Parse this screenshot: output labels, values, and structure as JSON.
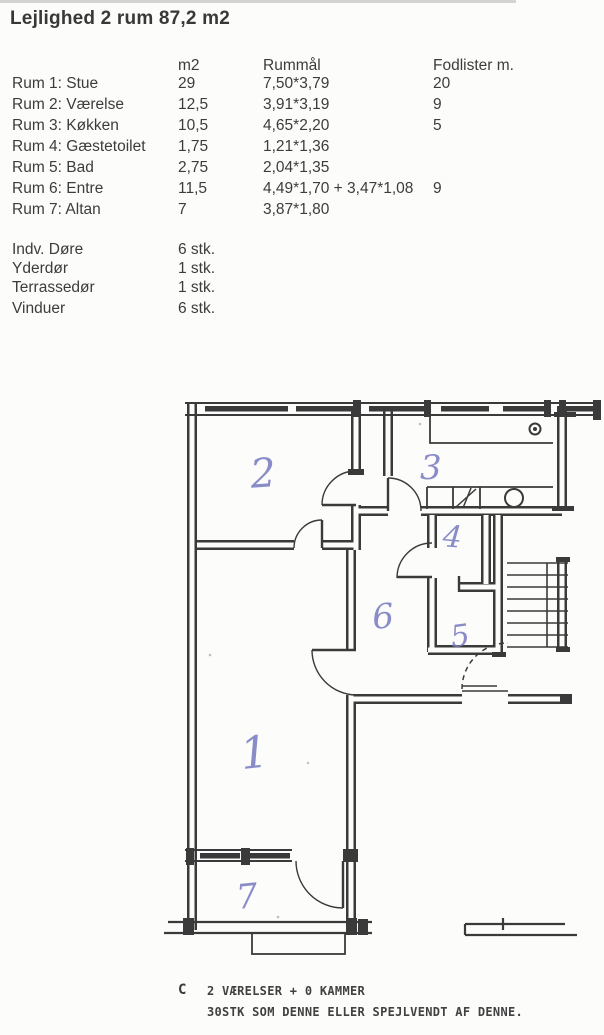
{
  "title": "Lejlighed 2 rum 87,2 m2",
  "room_table": {
    "headers": {
      "m2": "m2",
      "rummaal": "Rummål",
      "fodlister": "Fodlister m."
    },
    "rows": [
      {
        "label": "Rum 1: Stue",
        "m2": "29",
        "rummaal": "7,50*3,79",
        "fodlister": "20"
      },
      {
        "label": "Rum 2: Værelse",
        "m2": "12,5",
        "rummaal": "3,91*3,19",
        "fodlister": "9"
      },
      {
        "label": "Rum 3: Køkken",
        "m2": "10,5",
        "rummaal": "4,65*2,20",
        "fodlister": "5"
      },
      {
        "label": "Rum 4: Gæstetoilet",
        "m2": "1,75",
        "rummaal": "1,21*1,36",
        "fodlister": ""
      },
      {
        "label": "Rum 5: Bad",
        "m2": "2,75",
        "rummaal": "2,04*1,35",
        "fodlister": ""
      },
      {
        "label": "Rum 6: Entre",
        "m2": "11,5",
        "rummaal": "4,49*1,70 + 3,47*1,08",
        "fodlister": "9"
      },
      {
        "label": "Rum 7: Altan",
        "m2": "7",
        "rummaal": "3,87*1,80",
        "fodlister": ""
      }
    ]
  },
  "inventory": [
    {
      "label": "Indv. Døre",
      "value": "6 stk."
    },
    {
      "label": "Yderdør",
      "value": "1 stk."
    },
    {
      "label": "Terrassedør",
      "value": "1 stk."
    },
    {
      "label": "Vinduer",
      "value": "6 stk."
    }
  ],
  "floorplan": {
    "room_numbers": [
      "1",
      "2",
      "3",
      "4",
      "5",
      "6",
      "7"
    ]
  },
  "footer": {
    "type_letter": "C",
    "line1": "2 VÆRELSER + 0 KAMMER",
    "line2": "30STK SOM DENNE ELLER SPEJLVENDT AF DENNE."
  },
  "colors": {
    "ink": "#3a3a3a",
    "handwriting": "#7d80c3",
    "paper": "#fcfcfa"
  }
}
